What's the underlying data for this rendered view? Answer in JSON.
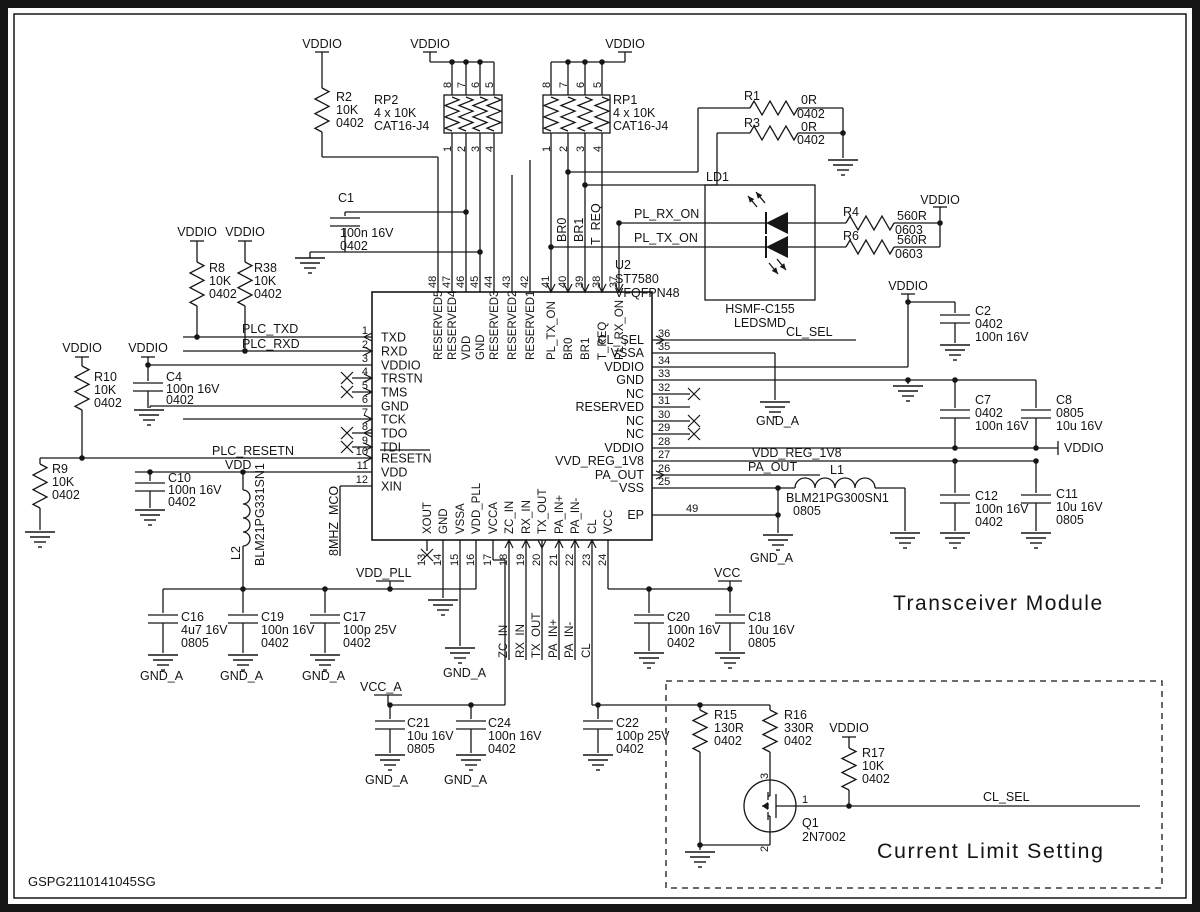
{
  "sheet": {
    "code": "GSPG2110141045SG",
    "module_title": "Transceiver Module",
    "section_title": "Current Limit Setting"
  },
  "chip": {
    "ref": "U2",
    "part": "ST7580",
    "package": "VFQFPN48",
    "left_pins": [
      [
        "1",
        "TXD"
      ],
      [
        "2",
        "RXD"
      ],
      [
        "3",
        "VDDIO"
      ],
      [
        "4",
        "TRSTN"
      ],
      [
        "5",
        "TMS"
      ],
      [
        "6",
        "GND"
      ],
      [
        "7",
        "TCK"
      ],
      [
        "8",
        "TDO"
      ],
      [
        "9",
        "TDI"
      ],
      [
        "10",
        "RESETN"
      ],
      [
        "11",
        "VDD"
      ],
      [
        "12",
        "XIN"
      ]
    ],
    "top_pins": [
      [
        "48",
        "RESERVED5"
      ],
      [
        "47",
        "RESERVED4"
      ],
      [
        "46",
        "VDD"
      ],
      [
        "45",
        "GND"
      ],
      [
        "44",
        "RESERVED3"
      ],
      [
        "43",
        "RESERVED2"
      ],
      [
        "42",
        "RESERVED1"
      ],
      [
        "41",
        "PL_TX_ON"
      ],
      [
        "40",
        "BR0"
      ],
      [
        "39",
        "BR1"
      ],
      [
        "38",
        "T_REQ"
      ],
      [
        "37",
        "PL_RX_ON"
      ]
    ],
    "right_pins": [
      [
        "36",
        "CL_SEL"
      ],
      [
        "35",
        "VSSA"
      ],
      [
        "34",
        "VDDIO"
      ],
      [
        "33",
        "GND"
      ],
      [
        "32",
        "NC"
      ],
      [
        "31",
        "RESERVED"
      ],
      [
        "30",
        "NC"
      ],
      [
        "29",
        "NC"
      ],
      [
        "28",
        "VDDIO"
      ],
      [
        "27",
        "VVD_REG_1V8"
      ],
      [
        "26",
        "PA_OUT"
      ],
      [
        "25",
        "VSS"
      ]
    ],
    "bottom_pins": [
      [
        "13",
        "XOUT"
      ],
      [
        "14",
        "GND"
      ],
      [
        "15",
        "VSSA"
      ],
      [
        "16",
        "VDD_PLL"
      ],
      [
        "17",
        "VCCA"
      ],
      [
        "18",
        "ZC_IN"
      ],
      [
        "19",
        "RX_IN"
      ],
      [
        "20",
        "TX_OUT"
      ],
      [
        "21",
        "PA_IN+"
      ],
      [
        "22",
        "PA_IN-"
      ],
      [
        "23",
        "CL"
      ],
      [
        "24",
        "VCC"
      ]
    ],
    "ep": [
      "49",
      "EP"
    ]
  },
  "packs": {
    "RP2": {
      "labels": [
        "RP2",
        "4 x 10K",
        "CAT16-J4"
      ],
      "top": [
        "8",
        "7",
        "6",
        "5"
      ],
      "bottom": [
        "1",
        "2",
        "3",
        "4"
      ]
    },
    "RP1": {
      "labels": [
        "RP1",
        "4 x 10K",
        "CAT16-J4"
      ],
      "top": [
        "8",
        "7",
        "6",
        "5"
      ],
      "bottom": [
        "1",
        "2",
        "3",
        "4"
      ]
    }
  },
  "components": {
    "R2": [
      "R2",
      "10K",
      "0402"
    ],
    "R8": [
      "R8",
      "10K",
      "0402"
    ],
    "R38": [
      "R38",
      "10K",
      "0402"
    ],
    "R10": [
      "R10",
      "10K",
      "0402"
    ],
    "R9": [
      "R9",
      "10K",
      "0402"
    ],
    "R1": [
      "R1",
      "0R",
      "0402"
    ],
    "R3": [
      "R3",
      "0R",
      "0402"
    ],
    "R4": [
      "R4",
      "560R",
      "0603"
    ],
    "R6": [
      "R6",
      "560R",
      "0603"
    ],
    "R15": [
      "R15",
      "130R",
      "0402"
    ],
    "R16": [
      "R16",
      "330R",
      "0402"
    ],
    "R17": [
      "R17",
      "10K",
      "0402"
    ],
    "C1": [
      "C1",
      "100n 16V",
      "0402"
    ],
    "C4": [
      "C4",
      "100n 16V",
      "0402"
    ],
    "C10": [
      "C10",
      "100n 16V",
      "0402"
    ],
    "C2": [
      "C2",
      "0402",
      "100n 16V"
    ],
    "C7": [
      "C7",
      "0402",
      "100n 16V"
    ],
    "C8": [
      "C8",
      "0805",
      "10u 16V"
    ],
    "C12": [
      "C12",
      "100n 16V",
      "0402"
    ],
    "C11": [
      "C11",
      "10u 16V",
      "0805"
    ],
    "C16": [
      "C16",
      "4u7 16V",
      "0805"
    ],
    "C19": [
      "C19",
      "100n 16V",
      "0402"
    ],
    "C17": [
      "C17",
      "100p 25V",
      "0402"
    ],
    "C20": [
      "C20",
      "100n 16V",
      "0402"
    ],
    "C18": [
      "C18",
      "10u 16V",
      "0805"
    ],
    "C21": [
      "C21",
      "10u 16V",
      "0805"
    ],
    "C24": [
      "C24",
      "100n 16V",
      "0402"
    ],
    "C22": [
      "C22",
      "100p 25V",
      "0402"
    ],
    "L2": [
      "L2",
      "BLM21PG331SN1"
    ],
    "L1": [
      "L1",
      "BLM21PG300SN1",
      "0805"
    ]
  },
  "led": {
    "ref": "LD1",
    "part": "HSMF-C155",
    "kind": "LEDSMD"
  },
  "q1": {
    "ref": "Q1",
    "part": "2N7002",
    "pin_top": "3",
    "pin_bottom": "2",
    "pin_right": "1"
  },
  "nets": {
    "vddio": "VDDIO",
    "plc_txd": "PLC_TXD",
    "plc_rxd": "PLC_RXD",
    "plc_resetn": "PLC_RESETN",
    "vdd": "VDD",
    "mco": "8MHZ_MCO",
    "vdd_pll": "VDD_PLL",
    "vcc_a": "VCC_A",
    "vcc": "VCC",
    "cl_sel": "CL_SEL",
    "pl_rx_on": "PL_RX_ON",
    "pl_tx_on": "PL_TX_ON",
    "br0": "BR0",
    "br1": "BR1",
    "t_req": "T_REQ",
    "vdd_reg": "VDD_REG_1V8",
    "pa_out": "PA_OUT",
    "gnd_a": "GND_A"
  }
}
